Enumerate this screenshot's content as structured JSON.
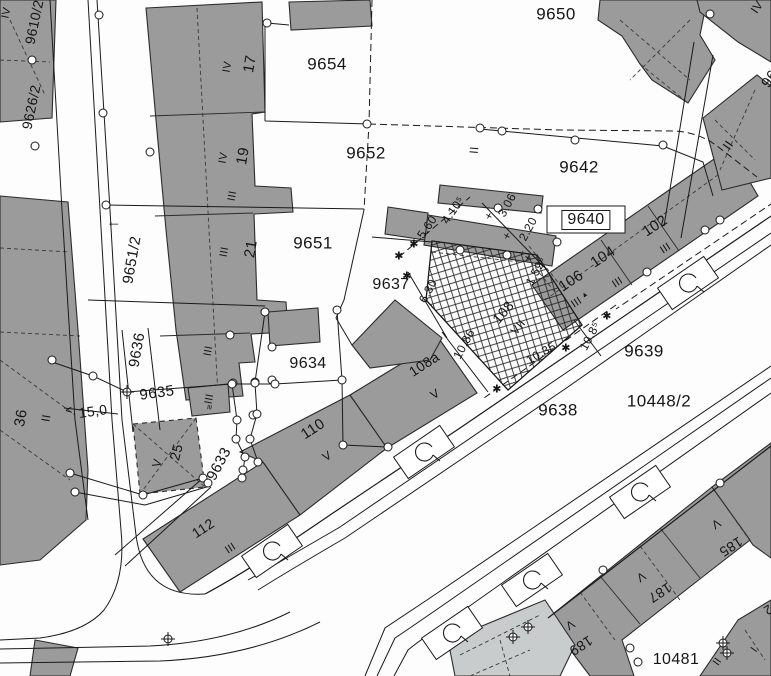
{
  "map": {
    "kind": "cadastral-parcel-map-scan",
    "colors": {
      "paper": "#fdfdfd",
      "building": "#9b9b9b",
      "building_light": "#c8cccd",
      "line": "#1a1a1a"
    },
    "region_labels": [
      {
        "t": "9650",
        "x": 556,
        "y": 14,
        "r": 0,
        "s": 17
      },
      {
        "t": "9654",
        "x": 327,
        "y": 64,
        "r": 0,
        "s": 17
      },
      {
        "t": "9652",
        "x": 366,
        "y": 153,
        "r": 0,
        "s": 17
      },
      {
        "t": "9642",
        "x": 579,
        "y": 167,
        "r": 0,
        "s": 17
      },
      {
        "t": "9640",
        "x": 586,
        "y": 220,
        "r": 0,
        "s": 16,
        "box": true
      },
      {
        "t": "9651",
        "x": 313,
        "y": 243,
        "r": 0,
        "s": 17
      },
      {
        "t": "9637",
        "x": 391,
        "y": 285,
        "r": 0,
        "s": 16
      },
      {
        "t": "9634",
        "x": 308,
        "y": 364,
        "r": 0,
        "s": 16
      },
      {
        "t": "9639",
        "x": 644,
        "y": 351,
        "r": 0,
        "s": 17
      },
      {
        "t": "9638",
        "x": 558,
        "y": 410,
        "r": 0,
        "s": 17
      },
      {
        "t": "10448/2",
        "x": 659,
        "y": 401,
        "r": 0,
        "s": 17
      },
      {
        "t": "10481",
        "x": 676,
        "y": 660,
        "r": 0,
        "s": 16
      },
      {
        "t": "9651/2",
        "x": 132,
        "y": 260,
        "r": -80,
        "s": 15
      },
      {
        "t": "9636",
        "x": 137,
        "y": 350,
        "r": -80,
        "s": 15
      },
      {
        "t": "9635",
        "x": 157,
        "y": 393,
        "r": -8,
        "s": 15
      },
      {
        "t": "9633",
        "x": 219,
        "y": 464,
        "r": -62,
        "s": 15
      },
      {
        "t": "9610/2",
        "x": 34,
        "y": 22,
        "r": -78,
        "s": 14
      },
      {
        "t": "9626/2",
        "x": 31,
        "y": 107,
        "r": -78,
        "s": 14
      },
      {
        "t": "96",
        "x": 770,
        "y": 79,
        "r": -55,
        "s": 15
      }
    ],
    "house_numbers": [
      {
        "t": "17",
        "x": 250,
        "y": 64,
        "r": -80,
        "s": 15
      },
      {
        "t": "19",
        "x": 243,
        "y": 156,
        "r": -80,
        "s": 15
      },
      {
        "t": "21",
        "x": 251,
        "y": 249,
        "r": -80,
        "s": 15
      },
      {
        "t": "25",
        "x": 176,
        "y": 452,
        "r": -75,
        "s": 14
      },
      {
        "t": "36",
        "x": 21,
        "y": 418,
        "r": -80,
        "s": 15
      },
      {
        "t": "102",
        "x": 655,
        "y": 226,
        "r": -33,
        "s": 15
      },
      {
        "t": "104",
        "x": 603,
        "y": 257,
        "r": -33,
        "s": 15
      },
      {
        "t": "106",
        "x": 571,
        "y": 281,
        "r": -33,
        "s": 15
      },
      {
        "t": "108",
        "x": 503,
        "y": 312,
        "r": -50,
        "s": 14
      },
      {
        "t": "108a",
        "x": 424,
        "y": 364,
        "r": -33,
        "s": 14
      },
      {
        "t": "110",
        "x": 313,
        "y": 429,
        "r": -33,
        "s": 15
      },
      {
        "t": "112",
        "x": 203,
        "y": 528,
        "r": -33,
        "s": 14
      },
      {
        "t": "185",
        "x": 731,
        "y": 547,
        "r": 147,
        "s": 14
      },
      {
        "t": "187",
        "x": 660,
        "y": 593,
        "r": 147,
        "s": 14
      },
      {
        "t": "189",
        "x": 581,
        "y": 646,
        "r": 147,
        "s": 14
      }
    ],
    "storey_marks": [
      {
        "t": "IV",
        "x": 228,
        "y": 67,
        "r": -80,
        "s": 11
      },
      {
        "t": "IV",
        "x": 224,
        "y": 158,
        "r": -80,
        "s": 11
      },
      {
        "t": "III",
        "x": 233,
        "y": 196,
        "r": -80,
        "s": 11
      },
      {
        "t": "III",
        "x": 225,
        "y": 252,
        "r": -80,
        "s": 11
      },
      {
        "t": "III",
        "x": 209,
        "y": 351,
        "r": -80,
        "s": 11
      },
      {
        "t": "III",
        "x": 210,
        "y": 399,
        "r": -80,
        "s": 11
      },
      {
        "t": "IV",
        "x": 7,
        "y": 13,
        "r": -78,
        "s": 11
      },
      {
        "t": "II",
        "x": 46,
        "y": 418,
        "r": -80,
        "s": 12
      },
      {
        "t": "V",
        "x": 157,
        "y": 463,
        "r": -75,
        "s": 12
      },
      {
        "t": "III",
        "x": 231,
        "y": 549,
        "r": -33,
        "s": 11
      },
      {
        "t": "V",
        "x": 327,
        "y": 456,
        "r": -33,
        "s": 12
      },
      {
        "t": "V",
        "x": 435,
        "y": 394,
        "r": -33,
        "s": 12
      },
      {
        "t": "VII",
        "x": 518,
        "y": 327,
        "r": -50,
        "s": 12
      },
      {
        "t": "III",
        "x": 666,
        "y": 249,
        "r": -33,
        "s": 11
      },
      {
        "t": "III",
        "x": 618,
        "y": 283,
        "r": -33,
        "s": 11
      },
      {
        "t": "III",
        "x": 577,
        "y": 303,
        "r": -33,
        "s": 11
      },
      {
        "t": "II",
        "x": 728,
        "y": 145,
        "r": -55,
        "s": 13
      },
      {
        "t": "IV",
        "x": 757,
        "y": 7,
        "r": -55,
        "s": 12
      },
      {
        "t": "II",
        "x": 474,
        "y": 150,
        "r": -85,
        "s": 12
      },
      {
        "t": "II",
        "x": 718,
        "y": 662,
        "r": -55,
        "s": 11
      },
      {
        "t": "I",
        "x": 755,
        "y": 650,
        "r": -55,
        "s": 11
      },
      {
        "t": "V",
        "x": 716,
        "y": 524,
        "r": 147,
        "s": 12
      },
      {
        "t": "V",
        "x": 641,
        "y": 577,
        "r": 147,
        "s": 12
      },
      {
        "t": "V",
        "x": 570,
        "y": 625,
        "r": 147,
        "s": 12
      },
      {
        "t": "2",
        "x": 768,
        "y": 610,
        "r": 147,
        "s": 13
      },
      {
        "t": "▲",
        "x": 585,
        "y": 295,
        "r": -33,
        "s": 7
      },
      {
        "t": "≡",
        "x": 210,
        "y": 407,
        "r": -80,
        "s": 9
      }
    ],
    "measurements": [
      {
        "t": "5.60",
        "x": 427,
        "y": 227,
        "r": -55,
        "s": 12
      },
      {
        "t": "4.10⁵",
        "x": 453,
        "y": 210,
        "r": -55,
        "s": 12
      },
      {
        "t": "3.06",
        "x": 507,
        "y": 205,
        "r": -62,
        "s": 12
      },
      {
        "t": "2.20",
        "x": 528,
        "y": 229,
        "r": -62,
        "s": 12
      },
      {
        "t": "1.59⁶",
        "x": 536,
        "y": 271,
        "r": -62,
        "s": 12
      },
      {
        "t": "6.30",
        "x": 428,
        "y": 291,
        "r": -62,
        "s": 12
      },
      {
        "t": "10.86",
        "x": 464,
        "y": 344,
        "r": -62,
        "s": 12
      },
      {
        "t": "10.35",
        "x": 541,
        "y": 353,
        "r": -30,
        "s": 12
      },
      {
        "t": "10.8⁵",
        "x": 590,
        "y": 336,
        "r": -62,
        "s": 12
      },
      {
        "t": "15,0",
        "x": 93,
        "y": 411,
        "r": -8,
        "s": 14
      }
    ],
    "annotations": [
      {
        "t": "←",
        "x": 114,
        "y": 222,
        "r": 0,
        "s": 15
      },
      {
        "t": "<",
        "x": 69,
        "y": 410,
        "r": -8,
        "s": 12
      },
      {
        "t": "✱",
        "x": 399,
        "y": 257,
        "r": 0,
        "s": 11
      },
      {
        "t": "✱",
        "x": 414,
        "y": 245,
        "r": 0,
        "s": 11
      },
      {
        "t": "✱",
        "x": 407,
        "y": 277,
        "r": 0,
        "s": 11
      },
      {
        "t": "✱",
        "x": 497,
        "y": 390,
        "r": 0,
        "s": 11
      },
      {
        "t": "✱",
        "x": 566,
        "y": 349,
        "r": 0,
        "s": 11
      },
      {
        "t": "✱",
        "x": 607,
        "y": 317,
        "r": 0,
        "s": 11
      },
      {
        "t": "+",
        "x": 489,
        "y": 216,
        "r": 28,
        "s": 12
      },
      {
        "t": "+",
        "x": 507,
        "y": 236,
        "r": 28,
        "s": 12
      },
      {
        "t": "+",
        "x": 528,
        "y": 258,
        "r": 28,
        "s": 12
      }
    ]
  }
}
